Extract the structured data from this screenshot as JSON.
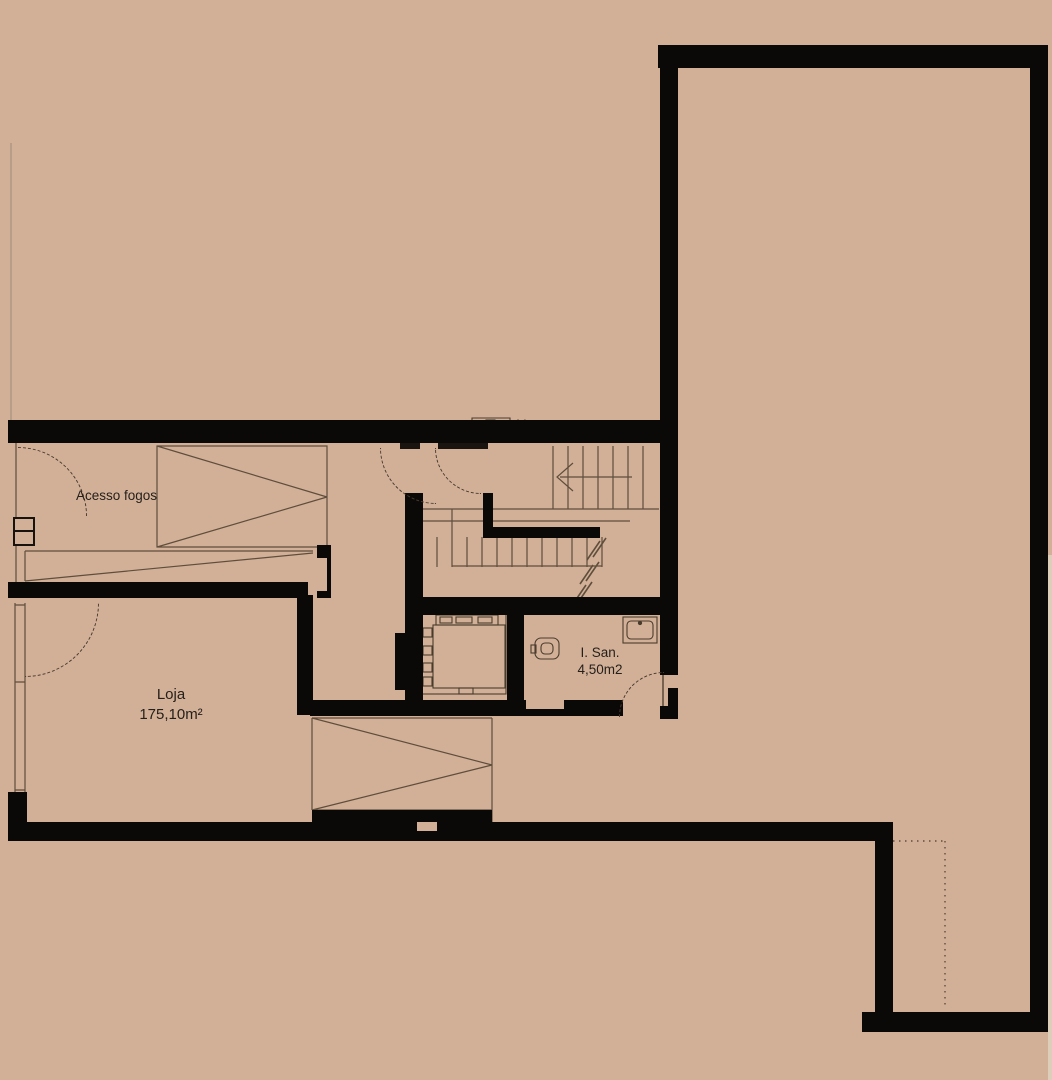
{
  "plan": {
    "labels": {
      "fire_access": "Acesso fogos",
      "shop_name": "Loja",
      "shop_area": "175,10m²",
      "wc_name": "I. San.",
      "wc_area": "4,50m2"
    },
    "colors": {
      "background": "#d2b098",
      "wall": "#0b0907",
      "line": "#5f4e3c",
      "text": "#241f19"
    }
  }
}
